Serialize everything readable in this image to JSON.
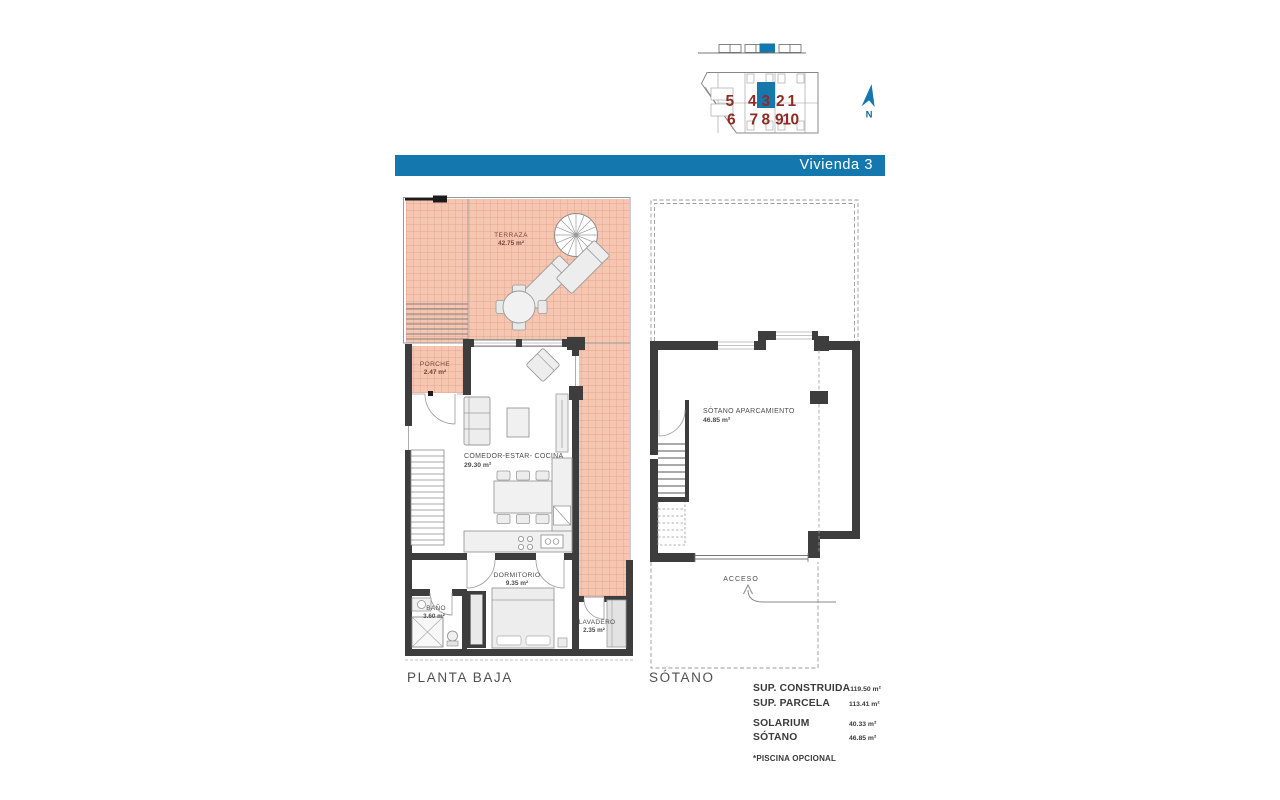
{
  "banner": {
    "title": "Vivienda 3"
  },
  "site_plan": {
    "units_row1": [
      {
        "label": "5"
      },
      {
        "label": "4"
      },
      {
        "label": "3"
      },
      {
        "label": "2"
      },
      {
        "label": "1"
      }
    ],
    "units_row2": [
      {
        "label": "6"
      },
      {
        "label": "7"
      },
      {
        "label": "8"
      },
      {
        "label": "9"
      },
      {
        "label": "10"
      }
    ],
    "highlighted_unit": "3",
    "north_label": "N"
  },
  "planta_baja": {
    "caption": "PLANTA BAJA",
    "rooms": {
      "terraza": {
        "name": "TERRAZA",
        "area": "42.75 m²"
      },
      "porche": {
        "name": "PORCHE",
        "area": "2.47 m²"
      },
      "comedor": {
        "name": "COMEDOR-ESTAR- COCINA",
        "area": "29.30 m²"
      },
      "dormitorio": {
        "name": "DORMITORIO",
        "area": "9.35 m²"
      },
      "bano": {
        "name": "BAÑO",
        "area": "3.60 m²"
      },
      "lavadero": {
        "name": "LAVADERO",
        "area": "2.35 m²"
      }
    }
  },
  "sotano": {
    "caption": "SÓTANO",
    "rooms": {
      "aparcamiento": {
        "name": "SÓTANO APARCAMIENTO",
        "area": "46.85 m²"
      },
      "acceso": {
        "name": "ACCESO"
      }
    }
  },
  "summary": {
    "rows": [
      {
        "label": "SUP. CONSTRUIDA",
        "value": "119.50 m²"
      },
      {
        "label": "SUP. PARCELA",
        "value": "113.41 m²"
      },
      {
        "label": "SOLARIUM",
        "value": "40.33 m²"
      },
      {
        "label": "SÓTANO",
        "value": "46.85 m²"
      }
    ],
    "footnote": "*PISCINA OPCIONAL"
  },
  "colors": {
    "banner_blue": "#1478ae",
    "unit_number_red": "#8e2b25",
    "tile_pink": "#f5c6b1",
    "tile_grid": "#e29b80",
    "wall_gray": "#3d3d3d"
  }
}
